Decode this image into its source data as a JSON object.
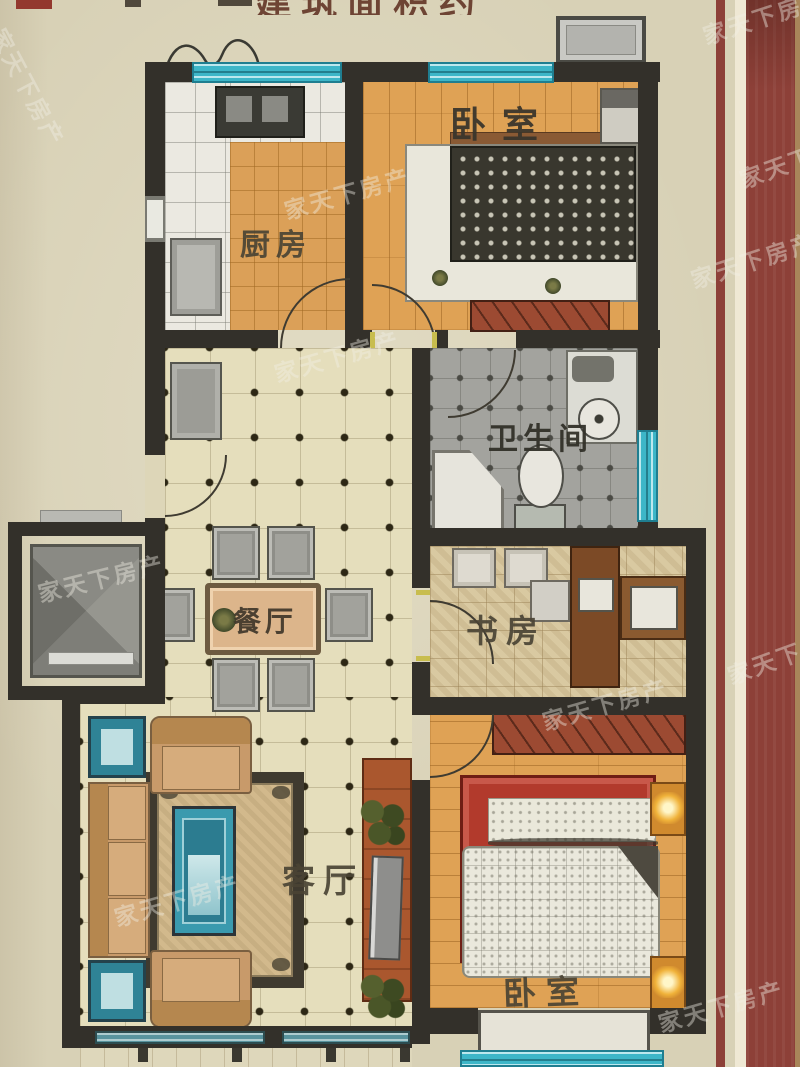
{
  "photo": {
    "watermark_text": "家天下房产",
    "top_cropped_text": "建筑面积约"
  },
  "rooms": {
    "kitchen": {
      "label": "厨房"
    },
    "bedroom_top": {
      "label": "卧室"
    },
    "bathroom": {
      "label": "卫生间"
    },
    "study": {
      "label": "书房"
    },
    "dining": {
      "label": "餐厅"
    },
    "living": {
      "label": "客厅"
    },
    "bedroom_bottom": {
      "label": "卧室"
    }
  },
  "colors": {
    "paper": "#d8d1b6",
    "wall": "#33302a",
    "window": "#3db6c8",
    "wood_floor": "#dfa255",
    "cream_floor": "#e5debc",
    "bathroom_floor": "#a3a39e",
    "parquet_floor": "#d9c9a1",
    "border_maroon": "#8d4038",
    "bed_red": "#b23a2c",
    "sofa_tan": "#c89a6a"
  }
}
